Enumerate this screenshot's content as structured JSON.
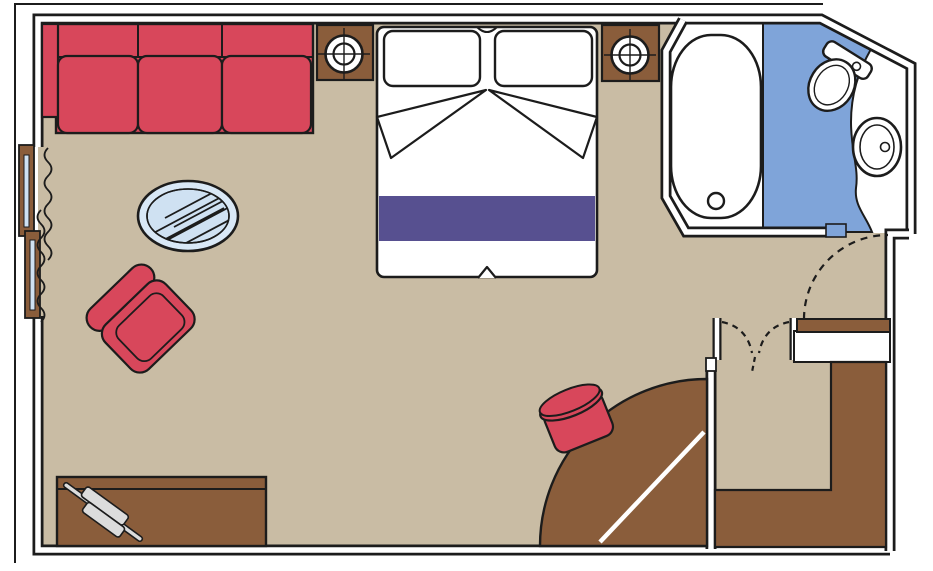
{
  "meta": {
    "title": "Cabin floor plan",
    "width": 933,
    "height": 571,
    "text_labels": []
  },
  "colors": {
    "floor": "#c9bca4",
    "wall_fill": "#ffffff",
    "outline": "#1c1c1c",
    "wood": "#8a5d3b",
    "upholstery": "#d8475b",
    "bed_runner": "#575090",
    "bath_floor": "#7fa4d9",
    "glass": "#d9e8f6",
    "glass_inner": "#cfe1f2",
    "accessory": "#dcdcdc"
  },
  "rooms": [
    {
      "name": "main-cabin",
      "floor_color": "#c9bca4"
    },
    {
      "name": "bathroom",
      "floor_color": "#7fa4d9"
    },
    {
      "name": "entrance-vestibule",
      "floor_color": "#c9bca4"
    }
  ],
  "furniture": [
    {
      "name": "sofa",
      "seats": 3,
      "color": "#d8475b"
    },
    {
      "name": "nightstand-left",
      "fixture": "lamp"
    },
    {
      "name": "nightstand-right",
      "fixture": "lamp"
    },
    {
      "name": "double-bed",
      "pillows": 2,
      "runner_color": "#575090"
    },
    {
      "name": "bathtub"
    },
    {
      "name": "toilet"
    },
    {
      "name": "sink"
    },
    {
      "name": "glass-coffee-table"
    },
    {
      "name": "armchair",
      "color": "#d8475b"
    },
    {
      "name": "desk",
      "object_on_top": "accessory"
    },
    {
      "name": "stool",
      "color": "#d8475b"
    },
    {
      "name": "entrance-door",
      "swing": "quarter-circle"
    },
    {
      "name": "wardrobe",
      "shape": "L"
    },
    {
      "name": "closet-double-doors",
      "swing": "dashed"
    },
    {
      "name": "bathroom-door",
      "swing": "dashed"
    },
    {
      "name": "balcony-sliding-door",
      "curtains": 2
    }
  ]
}
